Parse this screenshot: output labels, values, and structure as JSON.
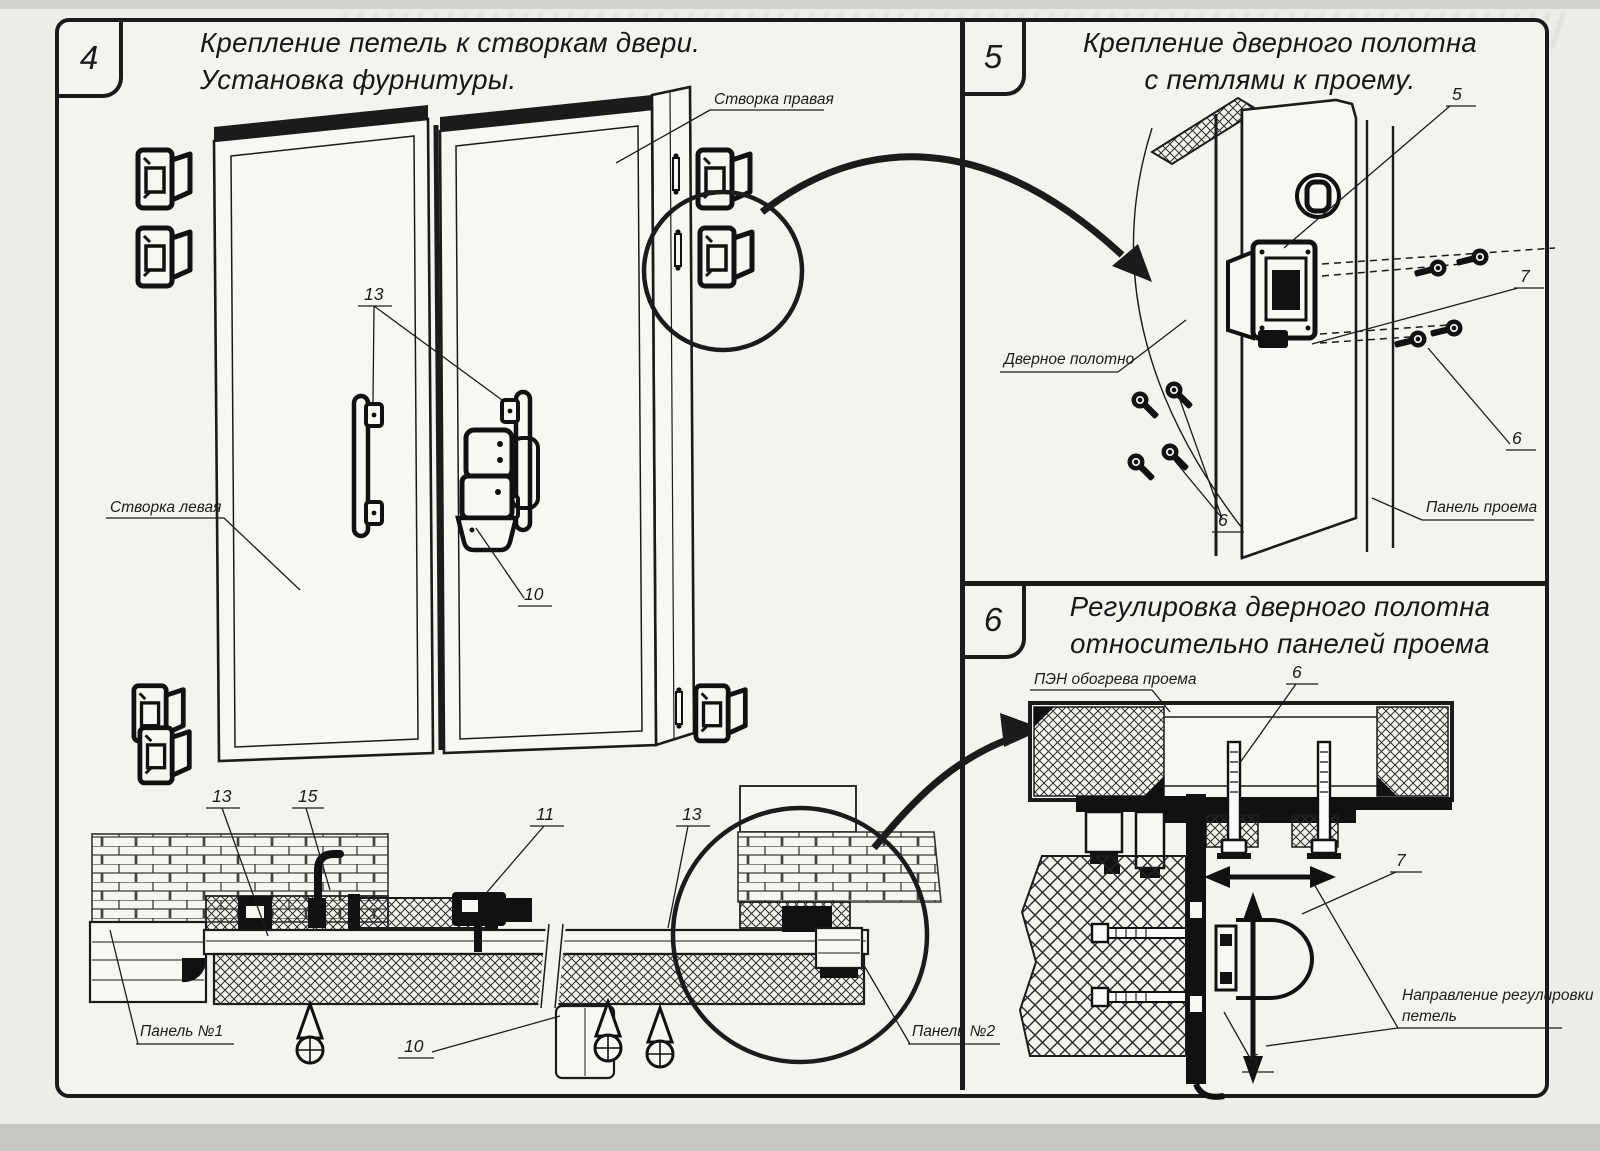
{
  "frame": {
    "panel4": {
      "number": "4",
      "title1": "Крепление петель к створкам двери.",
      "title2": "Установка фурнитуры."
    },
    "panel5": {
      "number": "5",
      "title1": "Крепление дверного полотна",
      "title2": "с петлями к проему."
    },
    "panel6": {
      "number": "6",
      "title1": "Регулировка дверного полотна",
      "title2": "относительно панелей проема"
    }
  },
  "labels4": {
    "leafRight": "Створка правая",
    "leafLeft": "Створка левая",
    "n13_handles": "13",
    "n13_left": "13",
    "n13_right": "13",
    "n15": "15",
    "n11": "11",
    "n10_lock": "10",
    "n10_section": "10",
    "panel1": "Панель №1",
    "panel2": "Панель №2"
  },
  "labels5": {
    "n5": "5",
    "n7": "7",
    "n6_right": "6",
    "n6_left": "6",
    "doorLeaf": "Дверное полотно",
    "openingPanel": "Панель проема"
  },
  "labels6": {
    "n6": "6",
    "n7": "7",
    "n5": "5",
    "pen": "ПЭН обогрева проема",
    "dir1": "Направление регулировки",
    "dir2": "петель"
  },
  "colors": {
    "ink": "#1b1b1b",
    "paper": "#f4f3ef"
  }
}
